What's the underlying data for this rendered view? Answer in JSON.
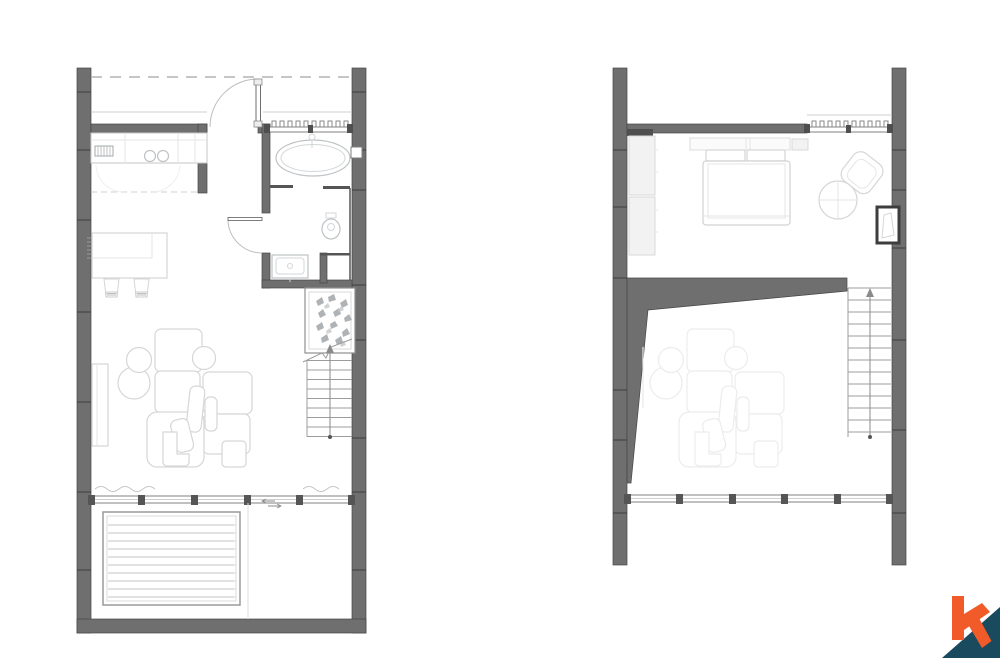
{
  "sheet": {
    "type": "architectural-floor-plan",
    "background": "#ffffff",
    "plans": [
      {
        "id": "ground-floor",
        "position": "left"
      },
      {
        "id": "upper-floor",
        "position": "right"
      }
    ]
  },
  "colors": {
    "wall": "#6f6f6f",
    "wall_outline": "#474747",
    "fixture_line": "#bfc3c5",
    "furniture_line": "#d6d6d6",
    "ghost_line": "#e5e5e5",
    "stair_line": "#9c9c9c",
    "plant": "#a2a6a9",
    "dashed_overhang": "#b3b3b3",
    "background": "#ffffff"
  },
  "ground_floor": {
    "fixtures": [
      "entry-door",
      "kitchen-counter",
      "cooktop-sink",
      "upper-cabinets-dashed",
      "kitchen-island",
      "bar-stools",
      "bathtub",
      "toilet",
      "washbasin-vanity",
      "louvre-window",
      "glass-partition",
      "planter-with-plants",
      "staircase-up",
      "tv-cabinet",
      "sofa-set",
      "round-coffee-tables",
      "side-table",
      "sliding-window-wall",
      "curtains",
      "pool-deck",
      "terrace"
    ]
  },
  "upper_floor": {
    "fixtures": [
      "wardrobe",
      "double-bed",
      "pillows",
      "armchair",
      "round-table",
      "wall-window-niche",
      "railing-louvre",
      "void-over-living",
      "ghost-sofa-below",
      "staircase-up",
      "window-wall"
    ]
  },
  "logo": {
    "letter": "k",
    "orange": "#f15a29",
    "teal": "#1a4a5e"
  }
}
